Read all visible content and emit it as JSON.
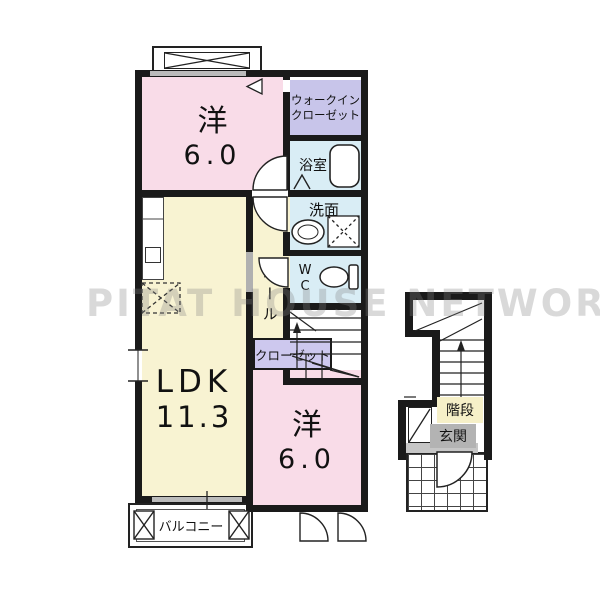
{
  "watermark": "PITAT HOUSE NETWORK",
  "colors": {
    "room_pink": "#f9dce8",
    "room_yellow": "#f8f3d2",
    "room_lavender": "#c8c5ea",
    "room_blue": "#d9edf5",
    "stairs_label_bg": "#f6f0c8",
    "entrance_label_bg": "#b3b3b3",
    "wall": "#1a1a1a"
  },
  "rooms": {
    "bedroom_top": {
      "name": "洋",
      "size": "6.0"
    },
    "walk_in_closet": {
      "line1": "ウォークイン",
      "line2": "クローゼット"
    },
    "bathroom": {
      "label": "浴室"
    },
    "washroom": {
      "label": "洗面"
    },
    "toilet": {
      "line1": "W",
      "line2": "C"
    },
    "hall": {
      "label": "ホール"
    },
    "closet": {
      "label": "クローゼット"
    },
    "ldk": {
      "name": "LDK",
      "size": "11.3"
    },
    "bedroom_bottom": {
      "name": "洋",
      "size": "6.0"
    },
    "balcony": {
      "label": "バルコニー"
    },
    "stairs": {
      "label": "階段"
    },
    "entrance": {
      "label": "玄関"
    }
  }
}
